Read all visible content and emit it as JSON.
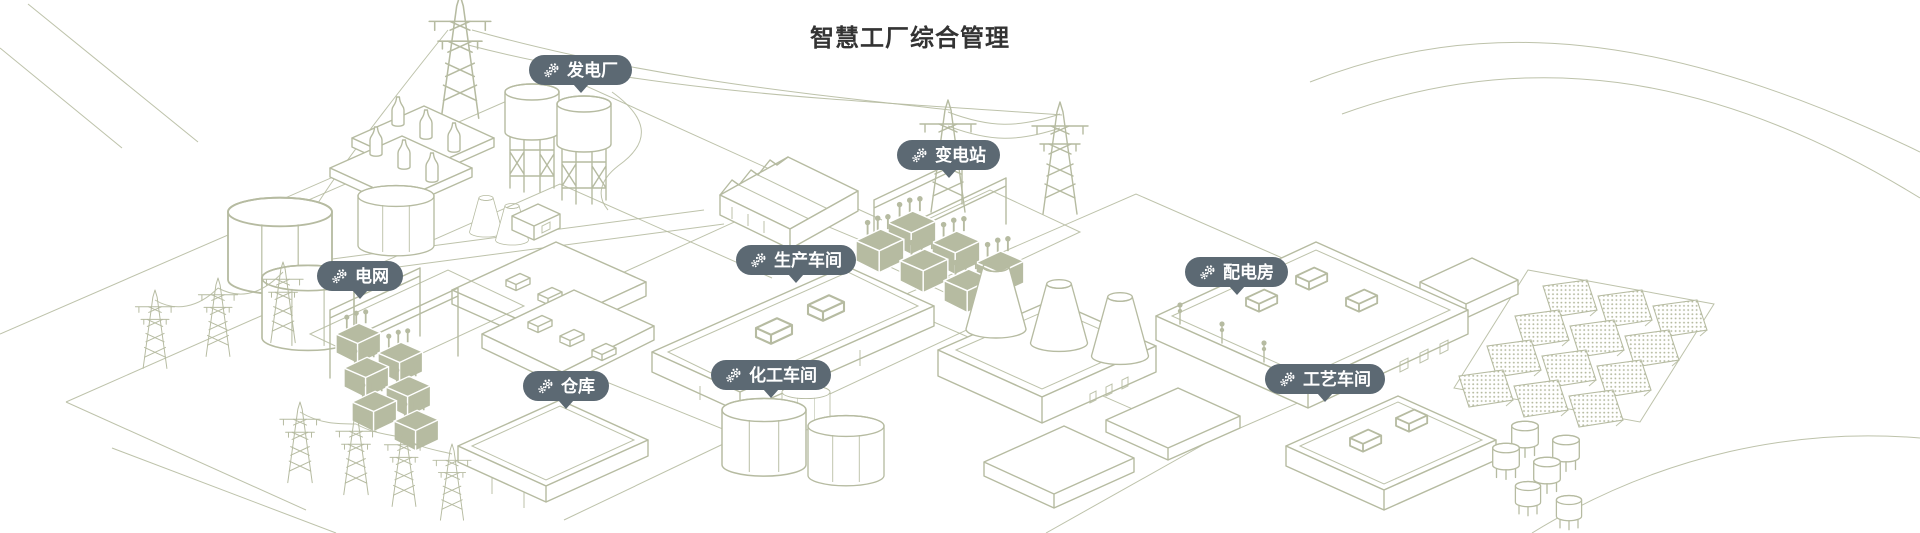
{
  "title": "智慧工厂综合管理",
  "colors": {
    "badge_background": "#5c6973",
    "badge_text": "#ffffff",
    "line_art": "#b6bba1",
    "title_text": "#333333"
  },
  "icons": {
    "pin": "gears-icon"
  },
  "pins": [
    {
      "id": "power-plant",
      "label": "发电厂"
    },
    {
      "id": "substation",
      "label": "变电站"
    },
    {
      "id": "power-grid",
      "label": "电网"
    },
    {
      "id": "production-workshop",
      "label": "生产车间"
    },
    {
      "id": "distribution-room",
      "label": "配电房"
    },
    {
      "id": "warehouse",
      "label": "仓库"
    },
    {
      "id": "chemical-workshop",
      "label": "化工车间"
    },
    {
      "id": "process-workshop",
      "label": "工艺车间"
    }
  ]
}
